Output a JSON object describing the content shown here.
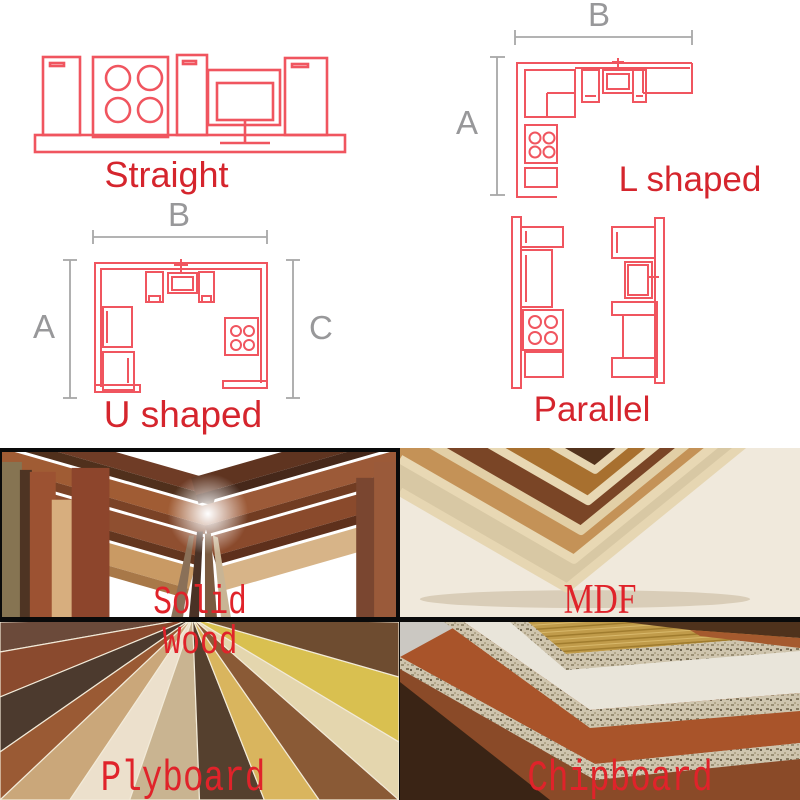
{
  "palette": {
    "diagram_stroke_red": "#f0555f",
    "dimension_gray": "#98989a",
    "layout_label_red": "#d5252d",
    "material_label_red": "#e0232a",
    "divider_black": "#0a0a0a"
  },
  "layouts": {
    "straight": {
      "label": "Straight"
    },
    "l_shaped": {
      "label": "L shaped",
      "dim_a": "A",
      "dim_b": "B"
    },
    "u_shaped": {
      "label": "U shaped",
      "dim_a": "A",
      "dim_b": "B",
      "dim_c": "C"
    },
    "parallel": {
      "label": "Parallel"
    }
  },
  "materials": {
    "solid_wood": {
      "label": "Solid Wood"
    },
    "mdf": {
      "label": "MDF"
    },
    "plyboard": {
      "label": "Plyboard"
    },
    "chipboard": {
      "label": "Chipboard"
    }
  }
}
